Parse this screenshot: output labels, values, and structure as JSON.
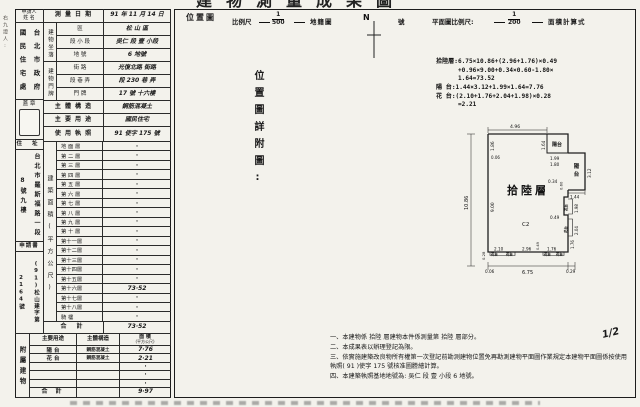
{
  "page": {
    "title": "建物測量成果圖",
    "margin_note": "右九證人:",
    "page_no": "1/2"
  },
  "header": {
    "applicant_label": "申請人",
    "applicant_label2": "姓 名",
    "applicant_name": "台北市政府國民住宅處",
    "survey_date_label": "測 量 日 期",
    "survey_date": "91 年 11 月 14 日",
    "seal_label": "蓋 章",
    "address_label": "住 址",
    "address": "台北市羅斯福路一段8號九樓",
    "application_label": "申請書",
    "application_no": "(91)松山建字第2164號"
  },
  "situs": {
    "group_label": "建物坐落",
    "rows": [
      {
        "label": "區",
        "value": "松 山 區"
      },
      {
        "label": "段 小 段",
        "value": "吳仁 段 壹 小段"
      },
      {
        "label": "地  號",
        "value": "6 地號"
      }
    ]
  },
  "doorplate": {
    "group_label": "建物門牌",
    "rows": [
      {
        "label": "街  路",
        "value": "光復北路 街路"
      },
      {
        "label": "段 巷 弄",
        "value": "段 230 巷  弄"
      },
      {
        "label": "門  牌",
        "value": "17 號 十六樓"
      }
    ]
  },
  "structure": {
    "label": "主 體 構 造",
    "value": "鋼筋混凝土"
  },
  "usage": {
    "label": "主 要 用 途",
    "value": "國民住宅"
  },
  "license": {
    "label": "使 用 執 照",
    "value": "91 使字 175 號"
  },
  "floors": {
    "group_label": "建築面積(平方公尺)",
    "rows": [
      {
        "label": "地 面 層",
        "value": "·"
      },
      {
        "label": "第 二 層",
        "value": "·"
      },
      {
        "label": "第 三 層",
        "value": "·"
      },
      {
        "label": "第 四 層",
        "value": "·"
      },
      {
        "label": "第 五 層",
        "value": "·"
      },
      {
        "label": "第 六 層",
        "value": "·"
      },
      {
        "label": "第 七 層",
        "value": "·"
      },
      {
        "label": "第 八 層",
        "value": "·"
      },
      {
        "label": "第 九 層",
        "value": "·"
      },
      {
        "label": "第 十 層",
        "value": "·"
      },
      {
        "label": "第十一層",
        "value": "·"
      },
      {
        "label": "第十二層",
        "value": "·"
      },
      {
        "label": "第十三層",
        "value": "·"
      },
      {
        "label": "第十四層",
        "value": "·"
      },
      {
        "label": "第十五層",
        "value": "·"
      },
      {
        "label": "第十六層",
        "value": "73·52"
      },
      {
        "label": "第十七層",
        "value": "·"
      },
      {
        "label": "第十八層",
        "value": "·"
      },
      {
        "label": "騎  樓",
        "value": "·"
      }
    ],
    "total_label": "合  計",
    "total": "73·52"
  },
  "annex": {
    "group_label": "附屬建物",
    "headers": {
      "use": "主要用途",
      "structure": "主體構造",
      "area": "面  積",
      "area2": "(平方公尺)"
    },
    "rows": [
      {
        "use": "陽 台",
        "structure": "鋼筋混凝土",
        "area": "7·76"
      },
      {
        "use": "花 台",
        "structure": "鋼筋混凝土",
        "area": "2·21"
      },
      {
        "use": "",
        "structure": "",
        "area": "·"
      },
      {
        "use": "",
        "structure": "",
        "area": "·"
      },
      {
        "use": "",
        "structure": "",
        "area": "·"
      }
    ],
    "total_label": "合  計",
    "total": "9·97"
  },
  "map": {
    "location_label": "位置圖",
    "scale_label": "比例尺",
    "scale_num": "1",
    "scale_den": "500",
    "cadastre_label": "地籍圖",
    "no_label": "號",
    "north": "N",
    "plan_scale_label": "平面圖比例尺:",
    "plan_num": "1",
    "plan_den": "200",
    "calc_label": "面積計算式",
    "detail_label": "位置圖詳附圖:"
  },
  "plan": {
    "formulas": [
      "拾陸層:6.75×10.86+(2.96+1.76)×0.49",
      "      +0.96×9.00+0.34×0.60-1.80×",
      "      1.64=73.52",
      "陽 台:1.44×3.12+1.99×1.64=7.76",
      "花 台:(2.10+1.76+2.04+1.98)×0.28",
      "      =2.21"
    ],
    "dims": {
      "top": "4.96",
      "left_total": "10.86",
      "left_upper": "1.86",
      "left_lower": "9.00",
      "left_gap": "0.06",
      "balc1": "陽台",
      "balc1_h": "1.64",
      "balc1_w1": "1.99",
      "balc1_w2": "1.80",
      "balc2a": "陽",
      "balc2b": "台",
      "balc2_h": "3.12",
      "balc2_w": "1.44",
      "notch_w": "0.34",
      "notch_h": "0.60",
      "right_fb1": "1.98",
      "right_fb2": "2.04",
      "right_step": "0.49",
      "mid_step": "0.49",
      "right_lower": "1.76",
      "br_fb": "1.76",
      "br_off": "0.29",
      "fb_w": "0.28",
      "fb_left": "2.10",
      "bottom_mid": "2.96",
      "bottom_total": "6.75",
      "bottom_left_off": "0.06",
      "room": "拾陸層",
      "unit": "C2",
      "fb_mark": "花台"
    }
  },
  "notes": [
    "一、本建物係 拾陸 層建物本件係測量第 拾陸 層部分。",
    "二、本成果表以辦理登記為限。",
    "三、依實施建築改良物所有權第一次登記前勘測建物位置免再勘測建物平面圖作業規定本建物平面圖係按使用執照( 91 )使字 175 號核准圖謄繪計算。",
    "四、本建築執照基地地號為:  吳仁 段 壹 小段  6  地號。"
  ]
}
